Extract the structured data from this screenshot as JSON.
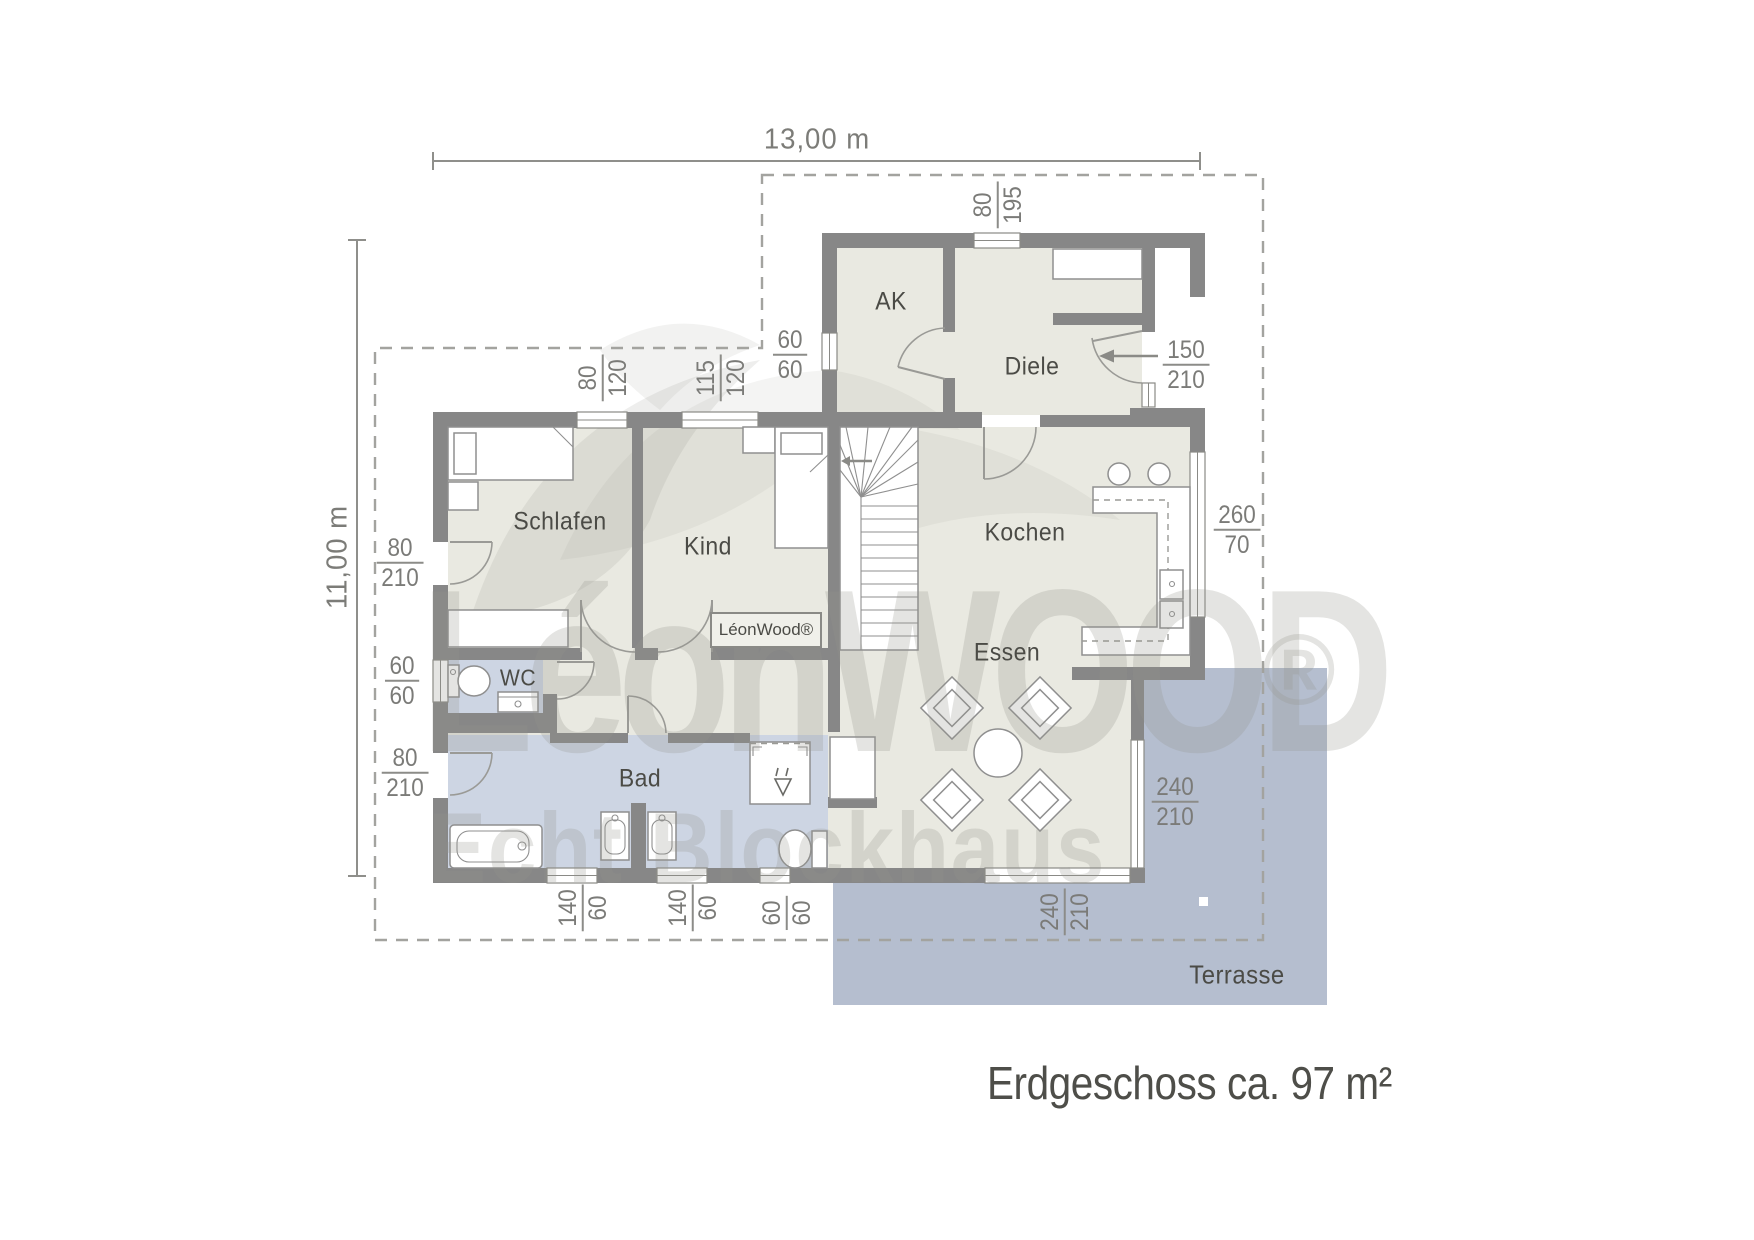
{
  "title": "Erdgeschoss ca. 97 m²",
  "dimensions": {
    "width": "13,00 m",
    "depth": "11,00 m"
  },
  "rooms": [
    {
      "name": "AK"
    },
    {
      "name": "Diele"
    },
    {
      "name": "Schlafen"
    },
    {
      "name": "Kind"
    },
    {
      "name": "Kochen"
    },
    {
      "name": "Essen"
    },
    {
      "name": "WC"
    },
    {
      "name": "Bad"
    },
    {
      "name": "Terrasse"
    }
  ],
  "opening_labels": [
    {
      "top": "80",
      "bottom": "195"
    },
    {
      "top": "60",
      "bottom": "60"
    },
    {
      "top": "150",
      "bottom": "210"
    },
    {
      "top": "80",
      "bottom": "120"
    },
    {
      "top": "115",
      "bottom": "120"
    },
    {
      "top": "260",
      "bottom": "70"
    },
    {
      "top": "80",
      "bottom": "210"
    },
    {
      "top": "60",
      "bottom": "60"
    },
    {
      "top": "80",
      "bottom": "210"
    },
    {
      "top": "240",
      "bottom": "210"
    },
    {
      "top": "140",
      "bottom": "60"
    },
    {
      "top": "140",
      "bottom": "60"
    },
    {
      "top": "60",
      "bottom": "60"
    },
    {
      "top": "240",
      "bottom": "210"
    }
  ],
  "watermark": {
    "brand": "LéonWOOD",
    "registered": "®",
    "tagline": "Echt Blockhaus",
    "badge": "LéonWood®"
  },
  "colors": {
    "wall": "#878787",
    "floor": "#e9e9e1",
    "wet": "#cdd5e3",
    "terrace": "#b5becf",
    "label": "#4b4b46",
    "dim": "#7b7b78"
  }
}
